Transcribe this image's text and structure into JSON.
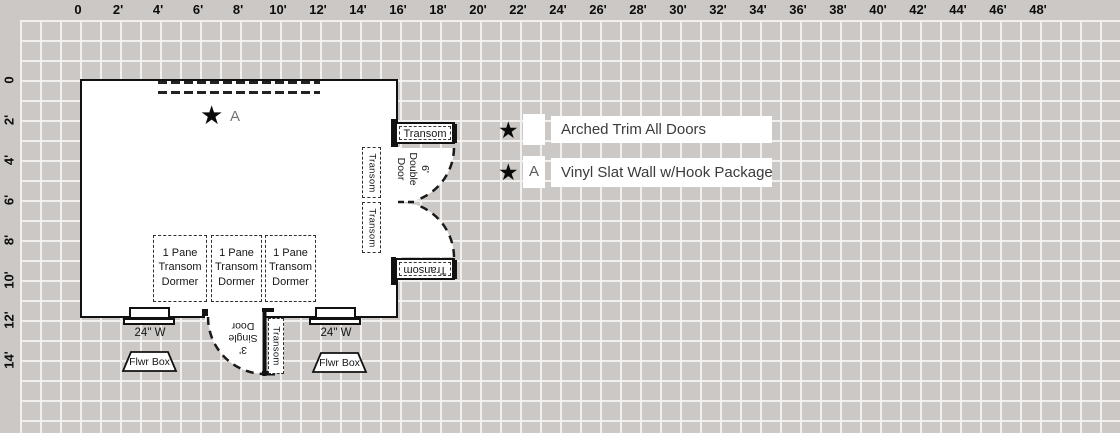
{
  "colors": {
    "background": "#cbc8c5",
    "grid_line": "#f1f0ee",
    "ink": "#111111",
    "muted_label": "#757575"
  },
  "rulers": {
    "top": [
      "0",
      "2'",
      "4'",
      "6'",
      "8'",
      "10'",
      "12'",
      "14'",
      "16'",
      "18'",
      "20'",
      "22'",
      "24'",
      "26'",
      "28'",
      "30'",
      "32'",
      "34'",
      "36'",
      "38'",
      "40'",
      "42'",
      "44'",
      "46'",
      "48'"
    ],
    "left": [
      "0",
      "2'",
      "4'",
      "6'",
      "8'",
      "10'",
      "12'",
      "14'"
    ]
  },
  "plan": {
    "marker": {
      "symbol": "★",
      "label": "A"
    },
    "dormers": [
      "1 Pane\nTransom\nDormer",
      "1 Pane\nTransom\nDormer",
      "1 Pane\nTransom\nDormer"
    ],
    "double_door": {
      "label": "6'\nDouble\nDoor",
      "transom_top": "Transom",
      "transom_bottom": "Transom"
    },
    "wall_transoms": [
      "Transom",
      "Transom"
    ],
    "single_door": {
      "label": "3'\nSingle\nDoor",
      "transom": "Transom"
    },
    "windows": [
      {
        "label": "24\" W",
        "flower_box": "Flwr Box"
      },
      {
        "label": "24\" W",
        "flower_box": "Flwr Box"
      }
    ]
  },
  "legend": {
    "rows": [
      {
        "symbol": "★",
        "key": "",
        "label": "Arched Trim All Doors"
      },
      {
        "symbol": "★",
        "key": "A",
        "label": "Vinyl Slat Wall w/Hook Package"
      }
    ]
  }
}
